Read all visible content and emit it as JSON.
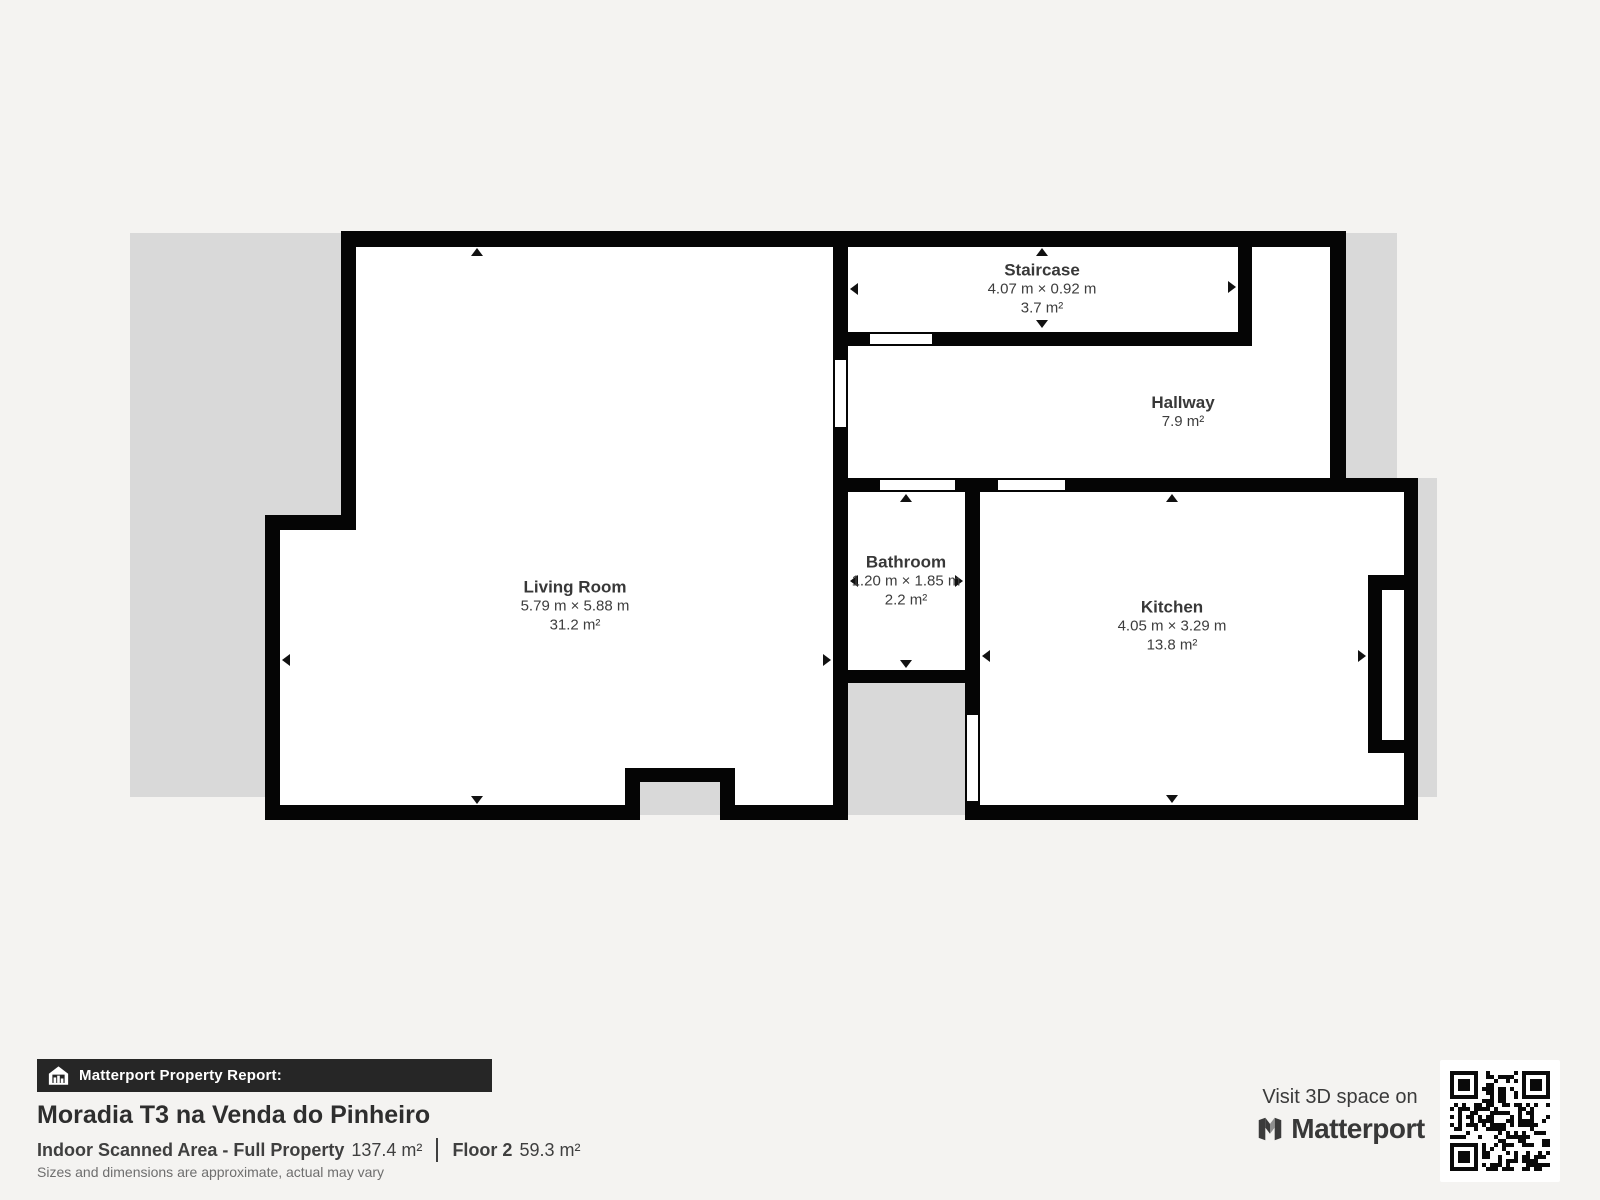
{
  "floorplan": {
    "rooms": [
      {
        "id": "living-room",
        "name": "Living Room",
        "dimensions": "5.79 m × 5.88 m",
        "area": "31.2 m²"
      },
      {
        "id": "staircase",
        "name": "Staircase",
        "dimensions": "4.07 m × 0.92 m",
        "area": "3.7 m²"
      },
      {
        "id": "hallway",
        "name": "Hallway",
        "dimensions": "",
        "area": "7.9 m²"
      },
      {
        "id": "bathroom",
        "name": "Bathroom",
        "dimensions": "1.20 m × 1.85 m",
        "area": "2.2 m²"
      },
      {
        "id": "kitchen",
        "name": "Kitchen",
        "dimensions": "4.05 m × 3.29 m",
        "area": "13.8 m²"
      }
    ]
  },
  "footer": {
    "report_label": "Matterport Property Report:",
    "property_title": "Moradia T3 na Venda do Pinheiro",
    "scanned_area_label": "Indoor Scanned Area - Full Property",
    "scanned_area_value": "137.4 m²",
    "floor_label": "Floor 2",
    "floor_value": "59.3 m²",
    "disclaimer": "Sizes and dimensions are approximate, actual may vary"
  },
  "promo": {
    "visit_text": "Visit 3D space on",
    "brand": "Matterport"
  },
  "colors": {
    "wall": "#050505",
    "unscanned": "#d9d9d9",
    "background": "#f4f3f1",
    "report_bar": "#262626"
  }
}
